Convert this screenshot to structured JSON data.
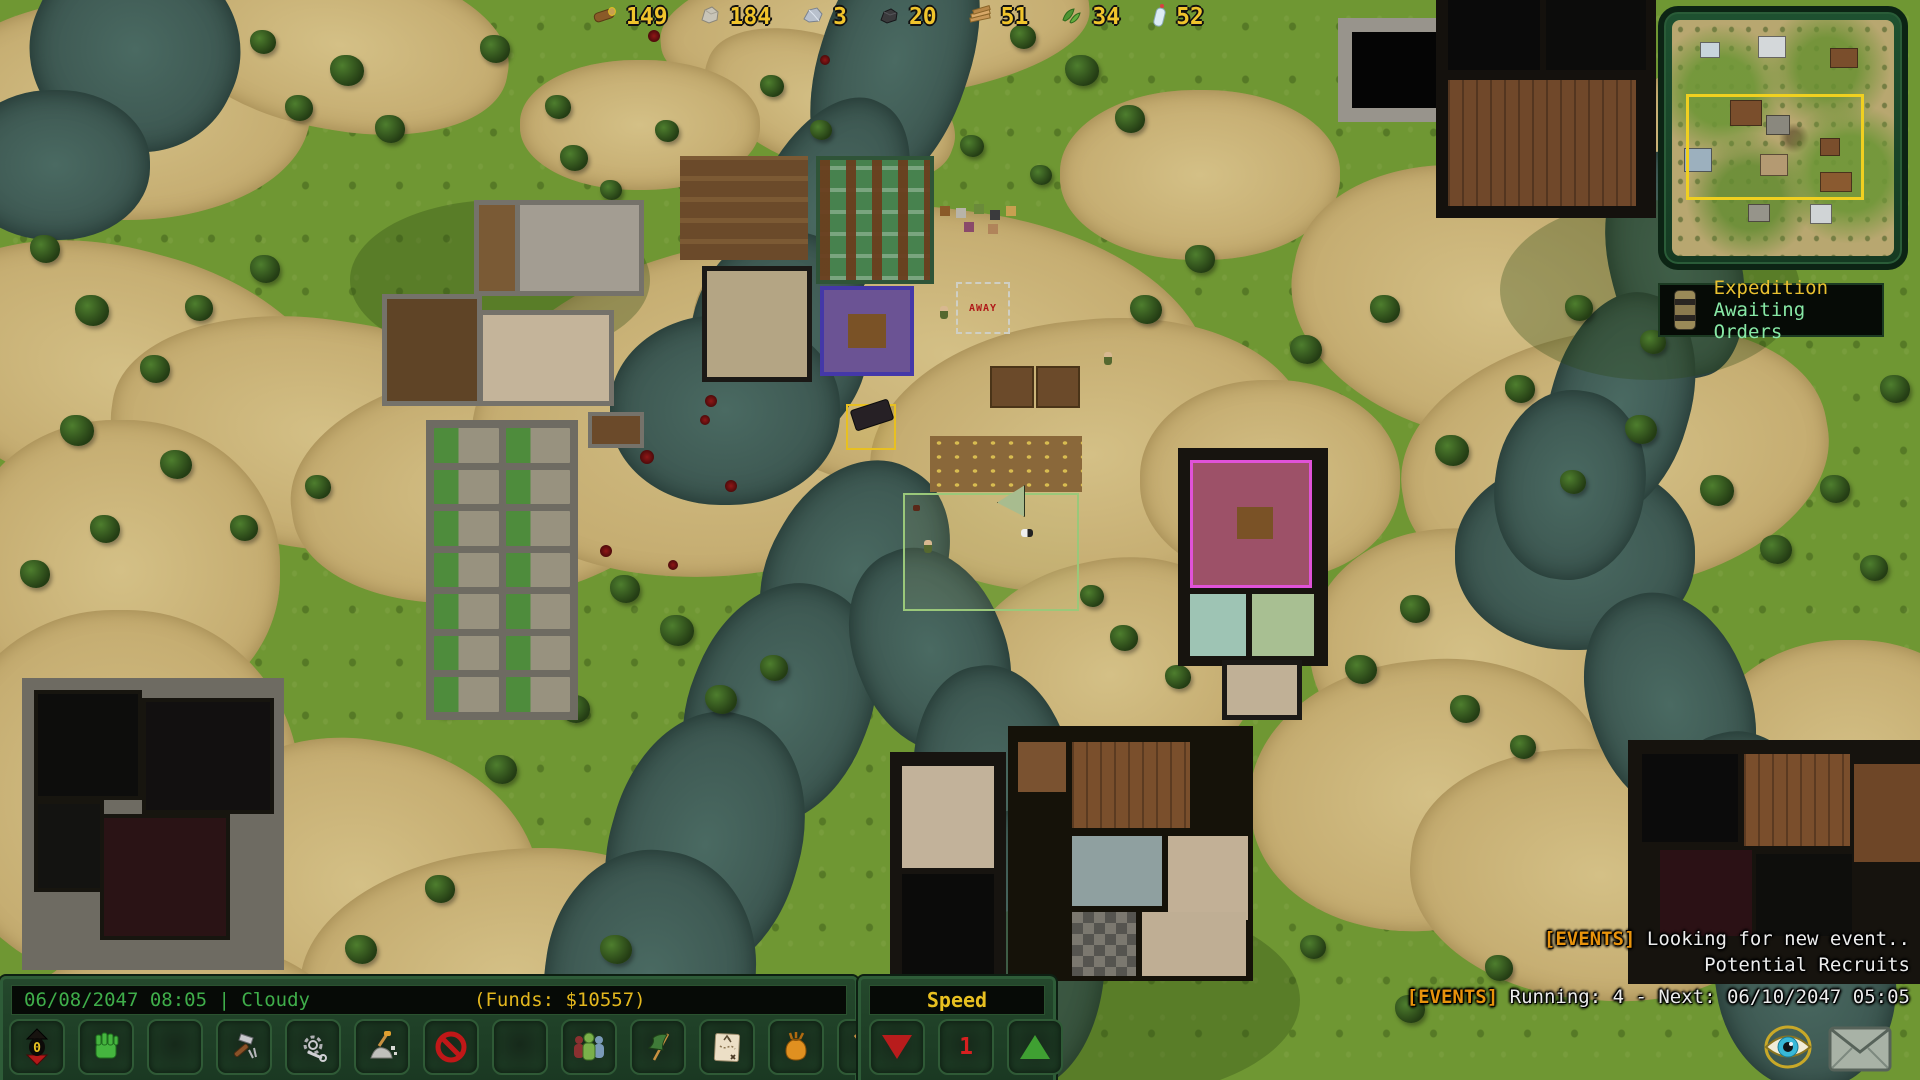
{
  "resources": {
    "items": [
      {
        "icon": "log-icon",
        "value": "149"
      },
      {
        "icon": "stone-icon",
        "value": "184"
      },
      {
        "icon": "silver-icon",
        "value": "3"
      },
      {
        "icon": "coal-icon",
        "value": "20"
      },
      {
        "icon": "planks-icon",
        "value": "51"
      },
      {
        "icon": "plants-icon",
        "value": "34"
      },
      {
        "icon": "water-bottle-icon",
        "value": "52"
      }
    ]
  },
  "expedition_panel": {
    "title": "Expedition",
    "status": "Awaiting Orders"
  },
  "status_bar": {
    "datetime": "06/08/2047 08:05 | Cloudy",
    "funds": "(Funds: $10557)"
  },
  "toolbar": {
    "items": [
      {
        "name": "elevation",
        "label": "0"
      },
      {
        "name": "orders"
      },
      {
        "name": "empty-slot-1"
      },
      {
        "name": "build"
      },
      {
        "name": "crafting"
      },
      {
        "name": "dig"
      },
      {
        "name": "forbid"
      },
      {
        "name": "empty-slot-2"
      },
      {
        "name": "population"
      },
      {
        "name": "zones"
      },
      {
        "name": "expedition-map"
      },
      {
        "name": "stockpile"
      },
      {
        "name": "mine"
      }
    ]
  },
  "speed_panel": {
    "title": "Speed",
    "current": "1"
  },
  "events": {
    "line1_tag": "[EVENTS]",
    "line1_text": "Looking for new event..",
    "line2_text": "Potential Recruits",
    "line3_tag": "[EVENTS]",
    "line3_text": "Running: 4 - Next: 06/10/2047 05:05"
  },
  "map_labels": {
    "away": "AWAY"
  },
  "colors": {
    "accent_yellow": "#f0c42c",
    "date_green": "#3fae4a",
    "funds_yellow": "#e3b71e",
    "speed_label": "#e8c020",
    "speed_value_red": "#d82020",
    "tri_red": "#b81c1c",
    "tri_green": "#3fa032",
    "event_orange": "#e8930c",
    "event_white": "#ececec",
    "expedition_yellow": "#e8c030",
    "expedition_green": "#87e8a5",
    "away_red": "#b01818",
    "selection_yellow": "#e8c020"
  }
}
